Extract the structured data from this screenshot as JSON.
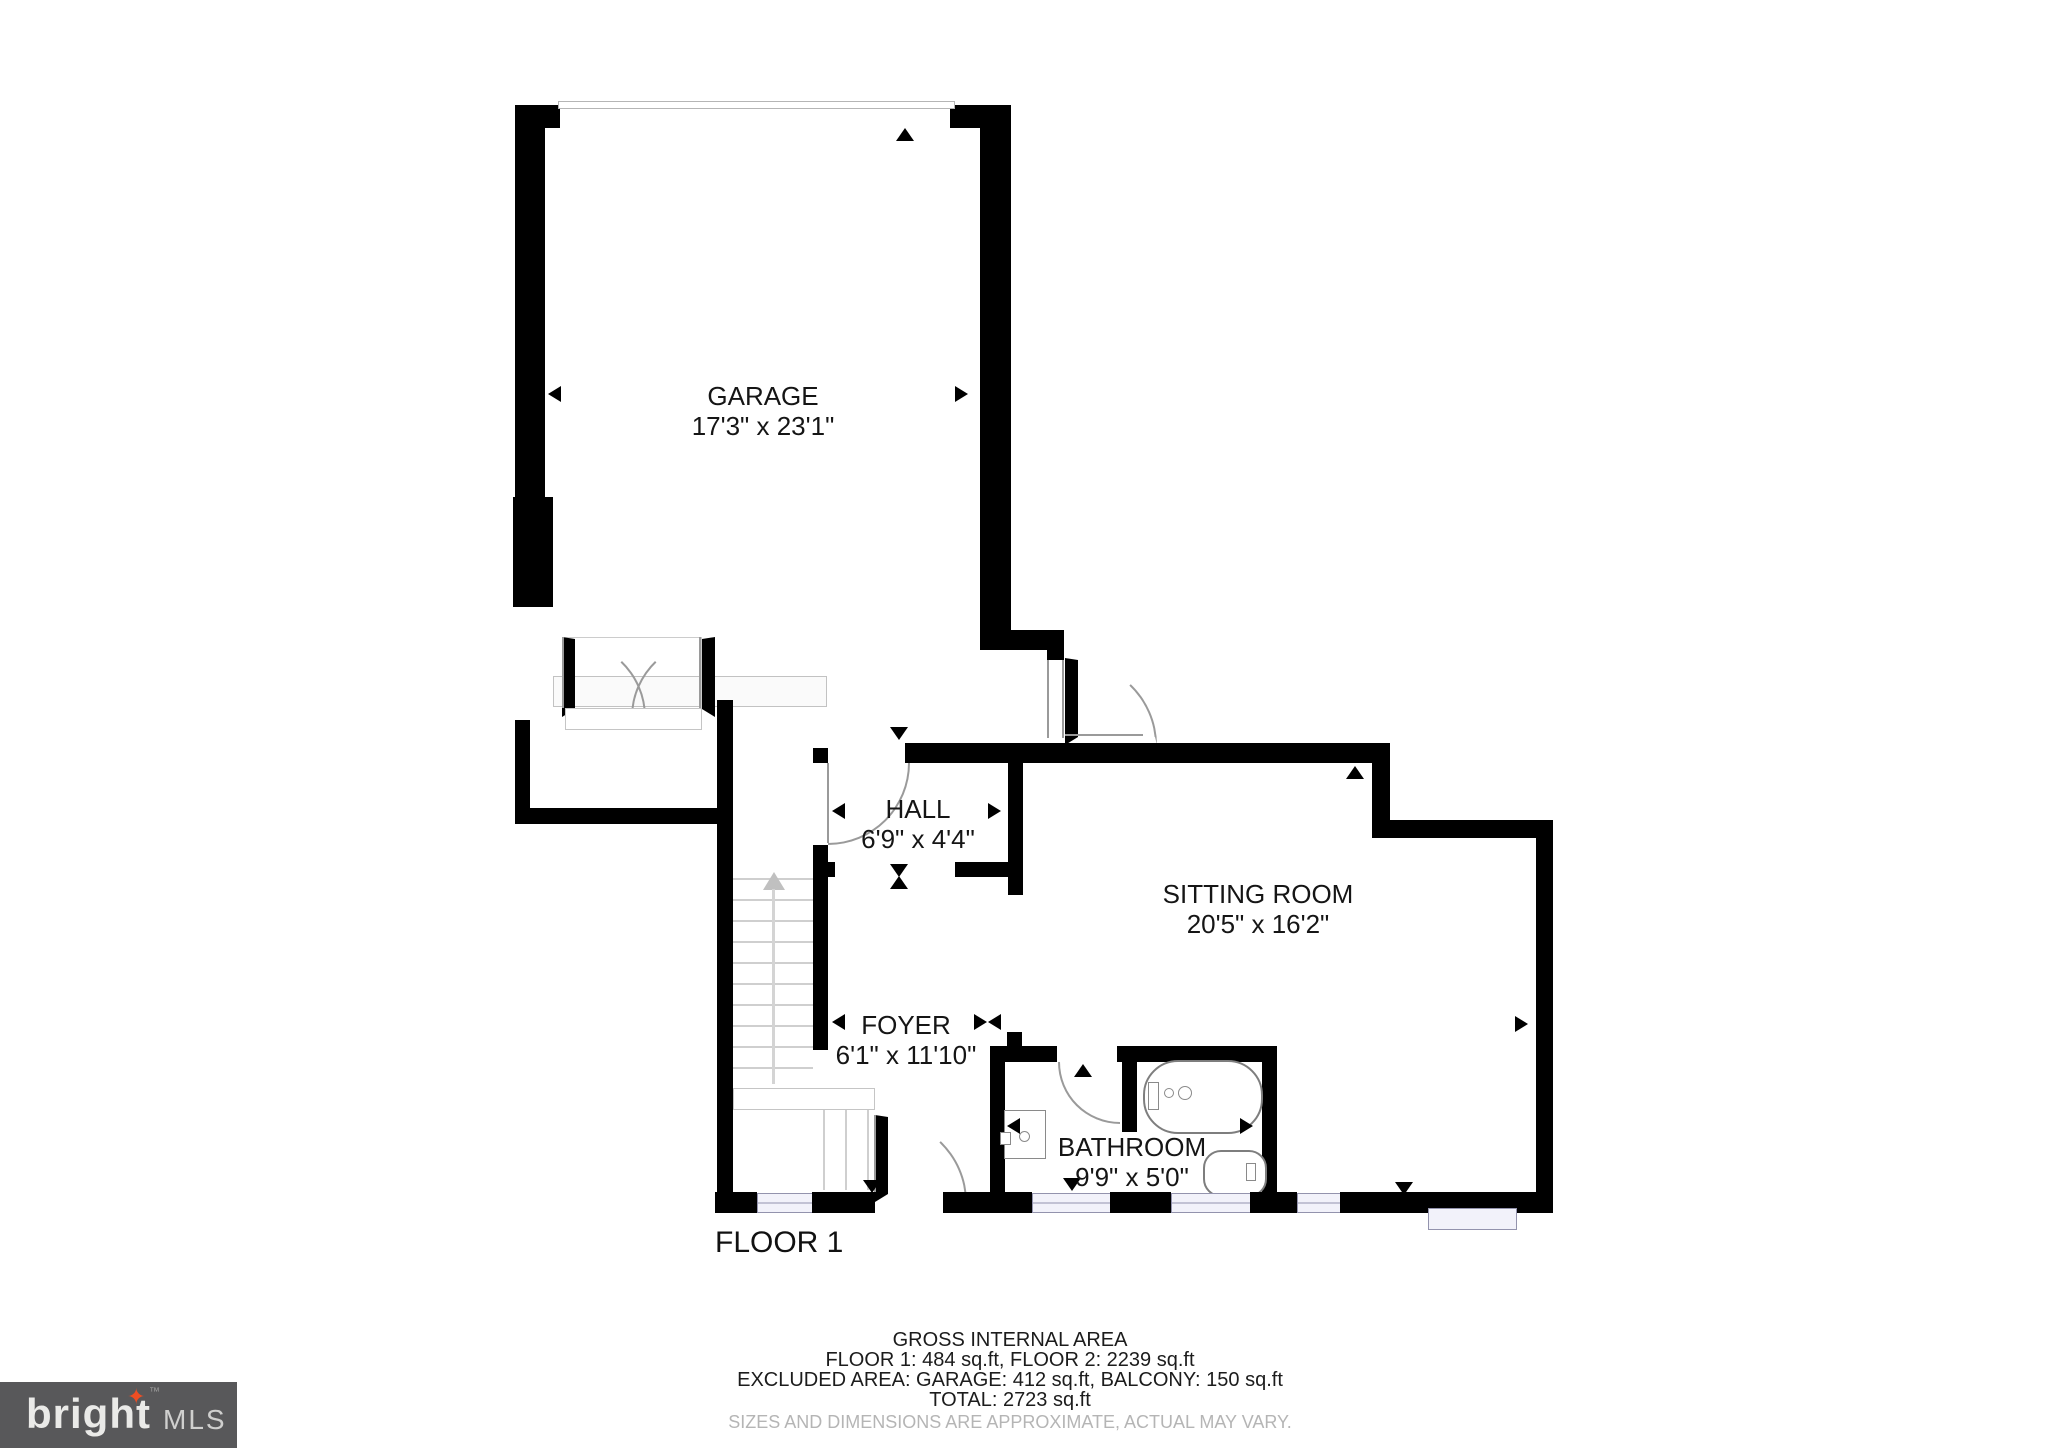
{
  "floor_label": "FLOOR 1",
  "rooms": {
    "garage": {
      "name": "GARAGE",
      "dims": "17'3\" x 23'1\""
    },
    "hall": {
      "name": "HALL",
      "dims": "6'9\" x 4'4\""
    },
    "sitting_room": {
      "name": "SITTING ROOM",
      "dims": "20'5\" x 16'2\""
    },
    "foyer": {
      "name": "FOYER",
      "dims": "6'1\" x 11'10\""
    },
    "bathroom": {
      "name": "BATHROOM",
      "dims": "9'9\" x 5'0\""
    }
  },
  "area_summary": {
    "title": "GROSS INTERNAL AREA",
    "floors": "FLOOR 1: 484 sq.ft, FLOOR 2: 2239 sq.ft",
    "excluded": "EXCLUDED AREA: GARAGE: 412 sq.ft, BALCONY: 150 sq.ft",
    "total": "TOTAL: 2723 sq.ft",
    "disclaimer": "SIZES AND DIMENSIONS ARE APPROXIMATE, ACTUAL MAY VARY."
  },
  "logo": {
    "brand": "bright",
    "tm": "™",
    "suffix": "MLS"
  },
  "colors": {
    "wall": "#000000",
    "window_fill": "#f2f2fa",
    "window_frame": "#9393ad",
    "door_arc": "#9a9a9a",
    "stair_line": "#cfcfcf",
    "logo_bg": "#58585a",
    "logo_text": "#eaeae8",
    "logo_star": "#f04e23",
    "disclaimer_text": "#b5b5b5"
  }
}
